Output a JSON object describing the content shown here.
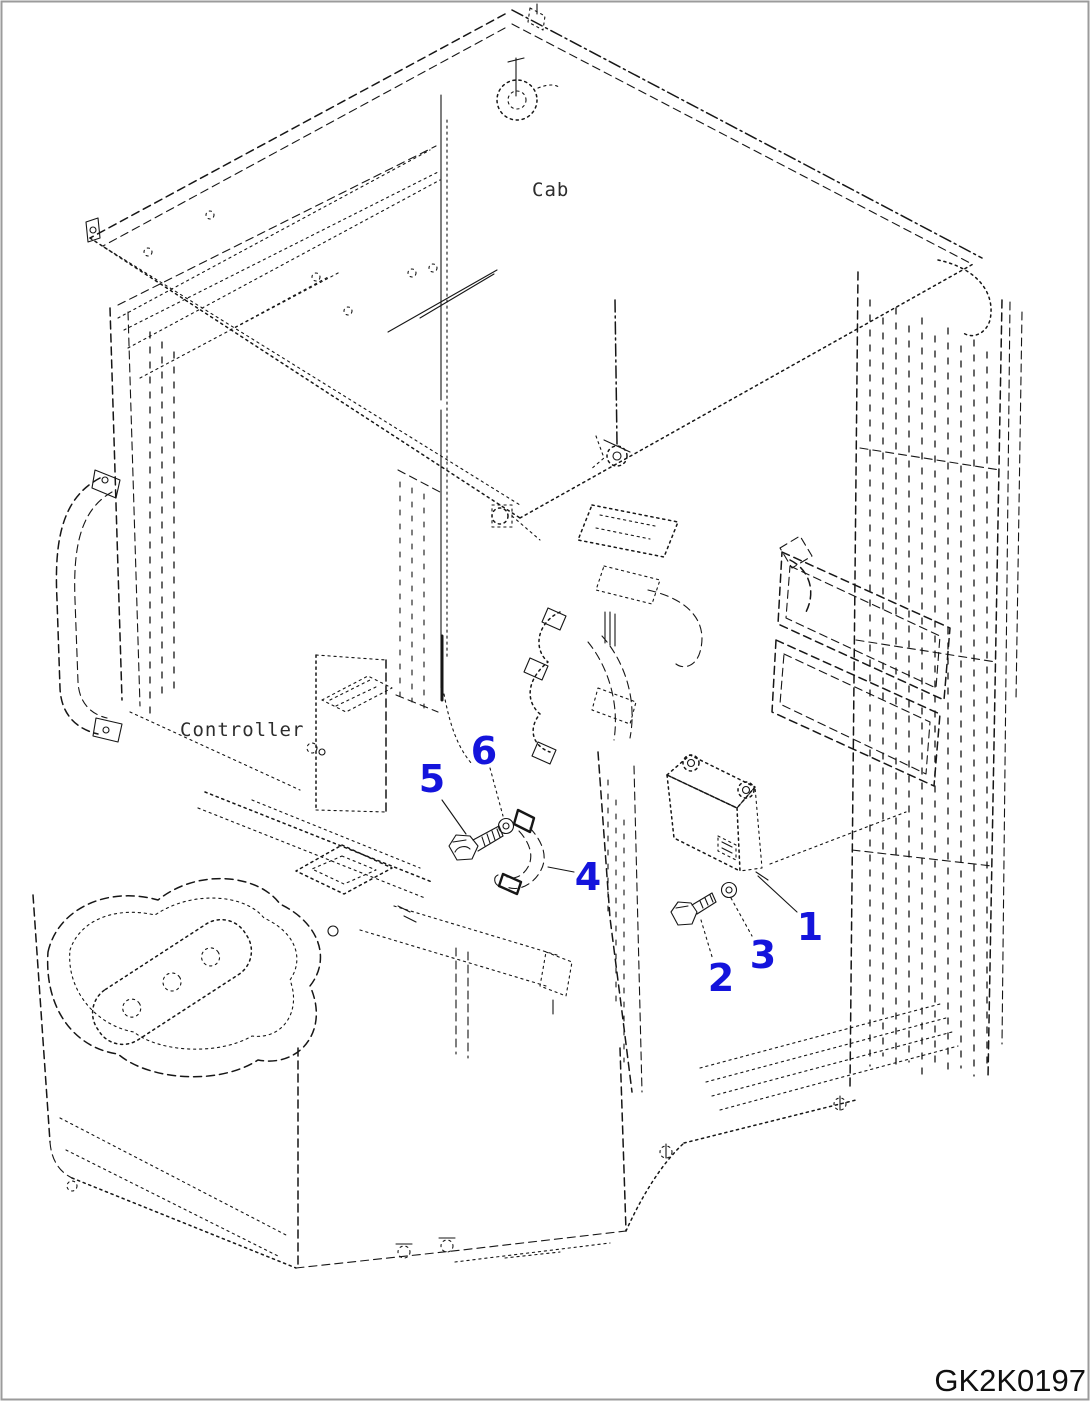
{
  "figure": {
    "code": "GK2K0197",
    "labels": {
      "cab": "Cab",
      "controller": "Controller"
    },
    "callouts": [
      {
        "number": "1"
      },
      {
        "number": "2"
      },
      {
        "number": "3"
      },
      {
        "number": "4"
      },
      {
        "number": "5"
      },
      {
        "number": "6"
      }
    ],
    "colors": {
      "callout_blue": "#1414dc",
      "line": "#161616"
    }
  }
}
